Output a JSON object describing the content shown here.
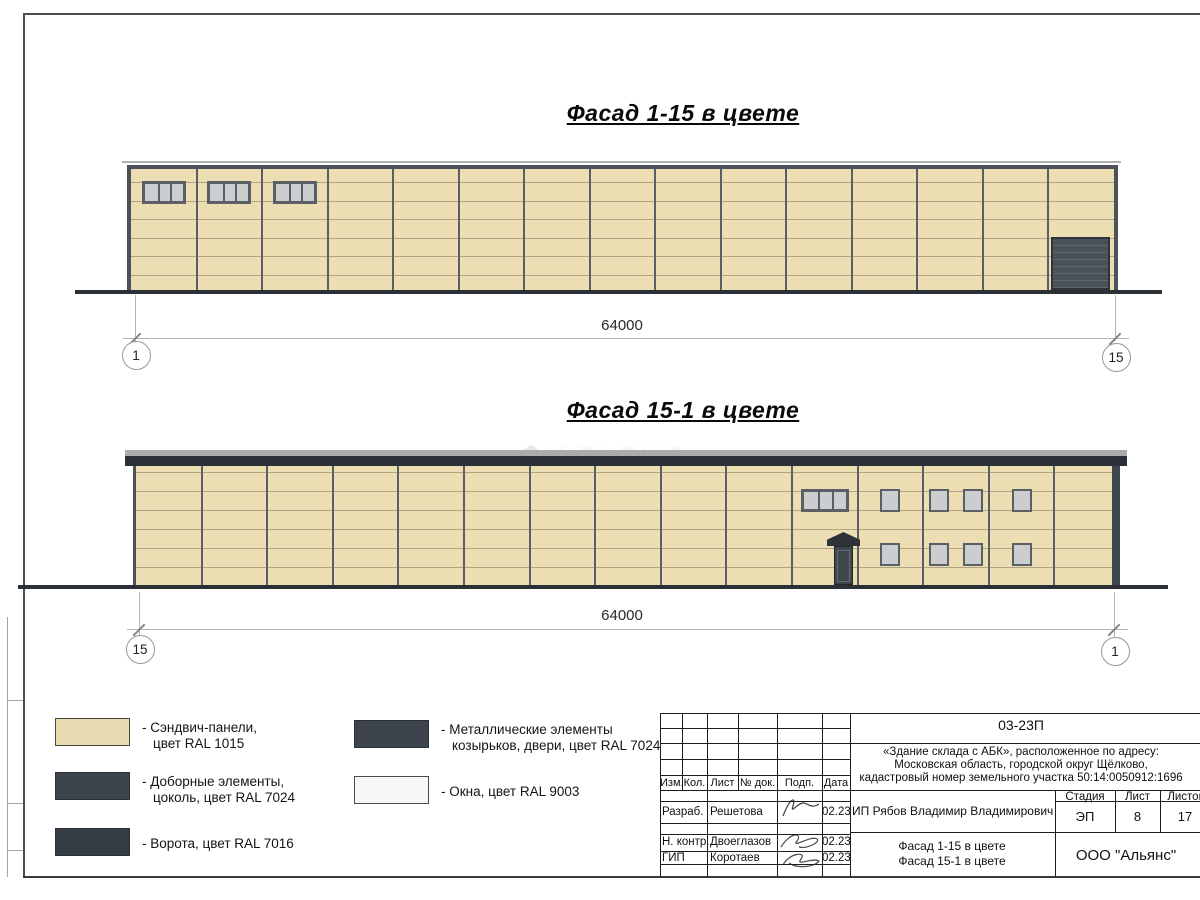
{
  "sheet": {
    "title_facade_1": "Фасад 1-15 в цвете",
    "title_facade_2": "Фасад 15-1 в цвете"
  },
  "dimensions": {
    "facade1": {
      "length": "64000",
      "axis_left": "1",
      "axis_right": "15"
    },
    "facade2": {
      "length": "64000",
      "axis_left": "15",
      "axis_right": "1"
    }
  },
  "watermark": {
    "title": "АЛЬЯНС",
    "subtitle": "строительная компания"
  },
  "legend": {
    "items": [
      {
        "swatch_color": "#e9dab1",
        "swatch_border": "#4a4a4a",
        "lines": [
          "- Сэндвич-панели,",
          "цвет RAL 1015"
        ]
      },
      {
        "swatch_color": "#3e444c",
        "swatch_border": "#2c3036",
        "lines": [
          "- Доборные элементы,",
          "цоколь, цвет RAL 7024"
        ]
      },
      {
        "swatch_color": "#363c44",
        "swatch_border": "#2c3036",
        "lines": [
          "- Ворота, цвет RAL 7016"
        ]
      },
      {
        "swatch_color": "#3e444c",
        "swatch_border": "#2c3036",
        "lines": [
          "- Металлические элементы",
          "козырьков, двери, цвет RAL 7024"
        ]
      },
      {
        "swatch_color": "#f6f7f6",
        "swatch_border": "#4a4a4a",
        "lines": [
          "- Окна, цвет RAL 9003"
        ]
      }
    ]
  },
  "title_block": {
    "doc_number": "03-23П",
    "project_lines": [
      "«Здание склада с АБК», расположенное по адресу:",
      "Московская область, городской округ Щёлково,",
      "кадастровый номер земельного участка 50:14:0050912:1696"
    ],
    "header_cols": [
      "Изм.",
      "Кол.",
      "Лист",
      "№ док.",
      "Подп.",
      "Дата"
    ],
    "signature_rows": [
      {
        "role": "Разраб.",
        "name": "Решетова",
        "date": "02.23"
      },
      {
        "role": "Н. контр.",
        "name": "Двоеглазов",
        "date": "02.23"
      },
      {
        "role": "ГИП",
        "name": "Коротаев",
        "date": "02.23"
      }
    ],
    "client": "ИП Рябов Владимир Владимирович",
    "stage_header": "Стадия",
    "sheet_header": "Лист",
    "sheets_header": "Листов",
    "stage": "ЭП",
    "sheet_number": "8",
    "sheets_total": "17",
    "drawing_titles": [
      "Фасад 1-15 в цвете",
      "Фасад 15-1 в цвете"
    ],
    "organization": "ООО \"Альянс\""
  },
  "colors": {
    "panel": "#ecddb3",
    "frame": "#4d525a",
    "column_line": "#5a5f66",
    "seam_line": "rgba(125,115,88,0.55)",
    "dark_band": "#2b3036",
    "gate": "#4a515a",
    "gate_slat": "#5d656f",
    "window_frame": "#5a5f65",
    "window_glass": "#cccdce",
    "door": "#3f454d",
    "ground": "#2c3136",
    "right_trim": "#40464e",
    "roof_grey": "#a9abad",
    "table_line": "#1d1d1d"
  }
}
